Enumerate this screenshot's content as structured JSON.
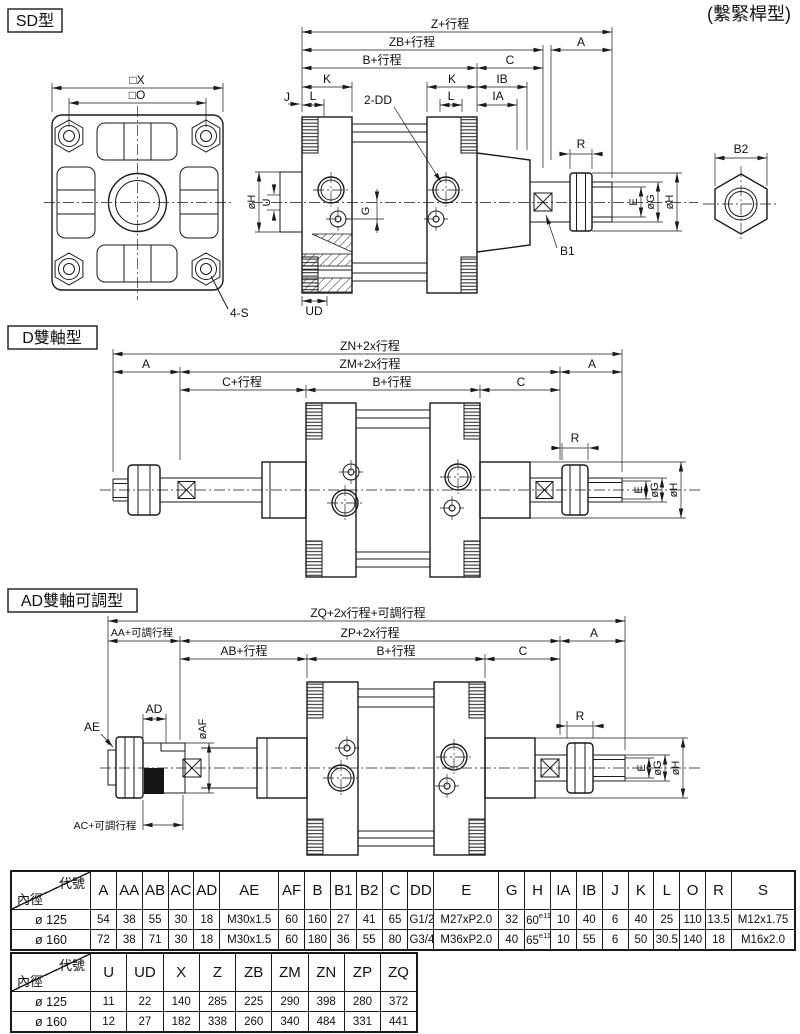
{
  "note_top_right": "(繫緊桿型)",
  "sd": {
    "title": "SD型",
    "front": {
      "x": "□X",
      "o": "□O",
      "s4": "4-S"
    },
    "dims": {
      "z": "Z+行程",
      "zb": "ZB+行程",
      "a": "A",
      "b": "B+行程",
      "c": "C",
      "k": "K",
      "ib": "IB",
      "ia": "IA",
      "j": "J",
      "l": "L",
      "dd": "2-DD",
      "g": "G",
      "ud": "UD",
      "u": "U",
      "oh": "øH",
      "r": "R",
      "b1": "B1",
      "b2": "B2",
      "e": "E",
      "og": "øG"
    }
  },
  "d": {
    "title": "D雙軸型",
    "dims": {
      "zn": "ZN+2x行程",
      "zm": "ZM+2x行程",
      "a": "A",
      "cs": "C+行程",
      "b": "B+行程",
      "c": "C",
      "r": "R",
      "e": "E",
      "og": "øG",
      "oh": "øH"
    }
  },
  "ad": {
    "title": "AD雙軸可調型",
    "dims": {
      "zq": "ZQ+2x行程+可調行程",
      "aa": "AA+可調行程",
      "zp": "ZP+2x行程",
      "a": "A",
      "ab": "AB+行程",
      "b": "B+行程",
      "c": "C",
      "ae": "AE",
      "ad": "AD",
      "af": "øAF",
      "ac": "AC+可調行程",
      "r": "R",
      "e": "E",
      "og": "øG",
      "oh": "øH"
    }
  },
  "table1": {
    "header_corner": {
      "top": "代號",
      "bottom": "內徑"
    },
    "columns": [
      "A",
      "AA",
      "AB",
      "AC",
      "AD",
      "AE",
      "AF",
      "B",
      "B1",
      "B2",
      "C",
      "DD",
      "E",
      "G",
      "H",
      "IA",
      "IB",
      "J",
      "K",
      "L",
      "O",
      "R",
      "S"
    ],
    "rows": [
      {
        "bore": "ø 125",
        "values": [
          "54",
          "38",
          "55",
          "30",
          "18",
          "M30x1.5",
          "60",
          "160",
          "27",
          "41",
          "65",
          "G1/2",
          "M27xP2.0",
          "32",
          {
            "v": "60",
            "sup": "e11"
          },
          "10",
          "40",
          "6",
          "40",
          "25",
          "110",
          "13.5",
          "M12x1.75"
        ]
      },
      {
        "bore": "ø 160",
        "values": [
          "72",
          "38",
          "71",
          "30",
          "18",
          "M30x1.5",
          "60",
          "180",
          "36",
          "55",
          "80",
          "G3/4",
          "M36xP2.0",
          "40",
          {
            "v": "65",
            "sup": "e11"
          },
          "10",
          "55",
          "6",
          "50",
          "30.5",
          "140",
          "18",
          "M16x2.0"
        ]
      }
    ]
  },
  "table2": {
    "header_corner": {
      "top": "代號",
      "bottom": "內徑"
    },
    "columns": [
      "U",
      "UD",
      "X",
      "Z",
      "ZB",
      "ZM",
      "ZN",
      "ZP",
      "ZQ"
    ],
    "rows": [
      {
        "bore": "ø 125",
        "values": [
          "11",
          "22",
          "140",
          "285",
          "225",
          "290",
          "398",
          "280",
          "372"
        ]
      },
      {
        "bore": "ø 160",
        "values": [
          "12",
          "27",
          "182",
          "338",
          "260",
          "340",
          "484",
          "331",
          "441"
        ]
      }
    ]
  }
}
